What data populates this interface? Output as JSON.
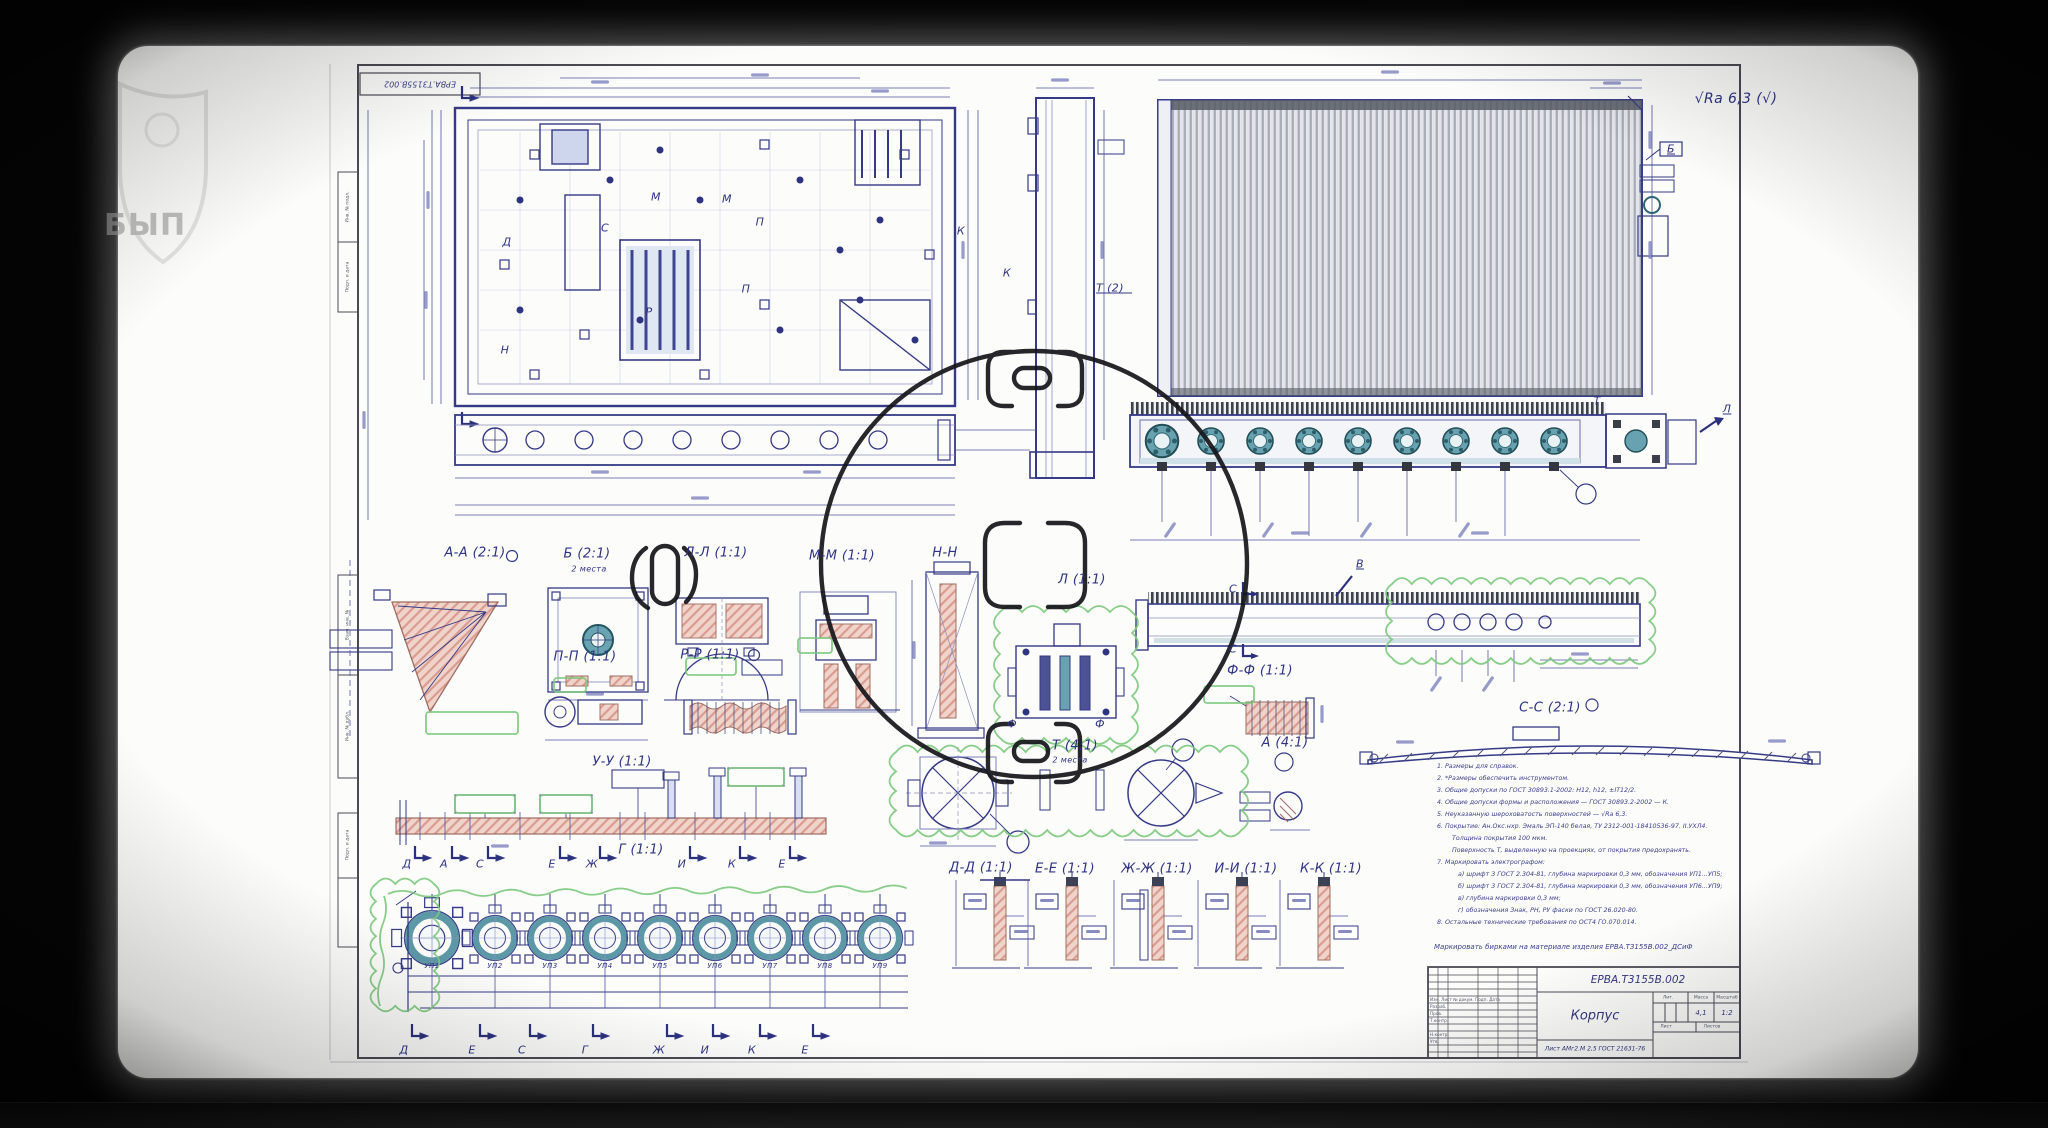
{
  "watermark": {
    "text": "БЫП"
  },
  "sheet": {
    "corner_stamp": "ЕРВА.Т3155В.002",
    "roughness_note": "√Ra 6,3 (√)"
  },
  "view_labels": {
    "aa": "А-А (2:1)",
    "b": "Б (2:1)",
    "b_note": "2 места",
    "ll": "Л-Л (1:1)",
    "mm": "М-М (1:1)",
    "nn": "Н-Н",
    "l": "Л (1:1)",
    "v": "В",
    "t2": "Т (2)",
    "pp": "П-П (1:1)",
    "rr": "Р-Р (1:1)",
    "uu": "У-У (1:1)",
    "g": "Г (1:1)",
    "ff": "Ф-Ф (1:1)",
    "cc": "С-С (2:1)",
    "t41": "Т (4:1)",
    "t41_note": "2 места",
    "a41": "А (4:1)",
    "dd": "Д-Д (1:1)",
    "ee": "Е-Е (1:1)",
    "zhzh": "Ж-Ж (1:1)",
    "ii": "И-И (1:1)",
    "kk": "К-К (1:1)",
    "f_left": "Ф",
    "f_right": "Ф",
    "s1": "С",
    "s2": "С",
    "k_plan": "К",
    "k_side": "К",
    "b_flag": "Б",
    "l_conn": "Л",
    "t_right": "Т"
  },
  "plan_letters": {
    "m1": "М",
    "m2": "М",
    "p1": "П",
    "p2": "П",
    "d": "Д",
    "s": "С",
    "r": "Р",
    "n": "Н"
  },
  "up_labels": [
    "УП1",
    "УП2",
    "УП3",
    "УП4",
    "УП5",
    "УП6",
    "УП7",
    "УП8",
    "УП9"
  ],
  "letters_top": [
    "Д",
    "А",
    "С",
    "Е",
    "Ж",
    "И",
    "К",
    "Е"
  ],
  "letters_bottom": [
    "Д",
    "Е",
    "С",
    "Г",
    "Ж",
    "И",
    "К",
    "Е"
  ],
  "notes": [
    "1. Размеры для справок.",
    "2. *Размеры обеспечить инструментом.",
    "3. Общие допуски по ГОСТ 30893.1-2002: Н12, h12, ±IT12/2.",
    "4. Общие допуски формы и расположения — ГОСТ 30893.2-2002 — К.",
    "5. Неуказанную шероховатость поверхностей — √Ra 6,3.",
    "6. Покрытие: Ан.Окс.нхр. Эмаль ЭП-140 белая, ТУ 2312-001-18410536-97. II.УХЛ4.",
    "Толщина покрытия 100 мкм.",
    "Поверхность Т, выделенную на проекциях, от покрытия предохранять.",
    "7. Маркировать электрографом:",
    "а) шрифт 3 ГОСТ 2.304-81, глубина маркировки 0,3 мм, обозначения УП1...УП5;",
    "б) шрифт 3 ГОСТ 2.304-81, глубина маркировки 0,3 мм, обозначения УП6...УП9;",
    "в) глубина маркировки 0,3 мм;",
    "г) обозначения Знак, РН, РУ фаски по ГОСТ 26.020-80.",
    "8. Остальные технические требования по ОСТ4 ГО.070.014."
  ],
  "title_block": {
    "marking_note": "Маркировать бирками на материале изделия ЕРВА.Т3155В.002_ДСиФ",
    "designation": "ЕРВА.Т3155В.002",
    "name": "Корпус",
    "material": "Лист АМг2.М 2,5 ГОСТ 21631-76",
    "lit_header": "Лит.",
    "mass_header": "Масса",
    "scale_header": "Масштаб",
    "mass": "4,1",
    "scale": "1:2",
    "sheet_word": "Лист",
    "sheets_word": "Листов",
    "header_row": "Изм. Лист  № докум.  Подп.  Дата",
    "roles": [
      "Разраб.",
      "Пров.",
      "Т.контр.",
      "Н.контр.",
      "Утв."
    ]
  },
  "side_stamp": [
    "Инв. № подл.",
    "Подп. и дата",
    "Взам. инв. №",
    "Инв. № дубл.",
    "Подп. и дата"
  ],
  "colors": {
    "line_blue": "#343a86",
    "teal": "#68a2b0",
    "pink": "#f0d4cb",
    "green": "#7cc97c",
    "ink": "#15151a"
  }
}
